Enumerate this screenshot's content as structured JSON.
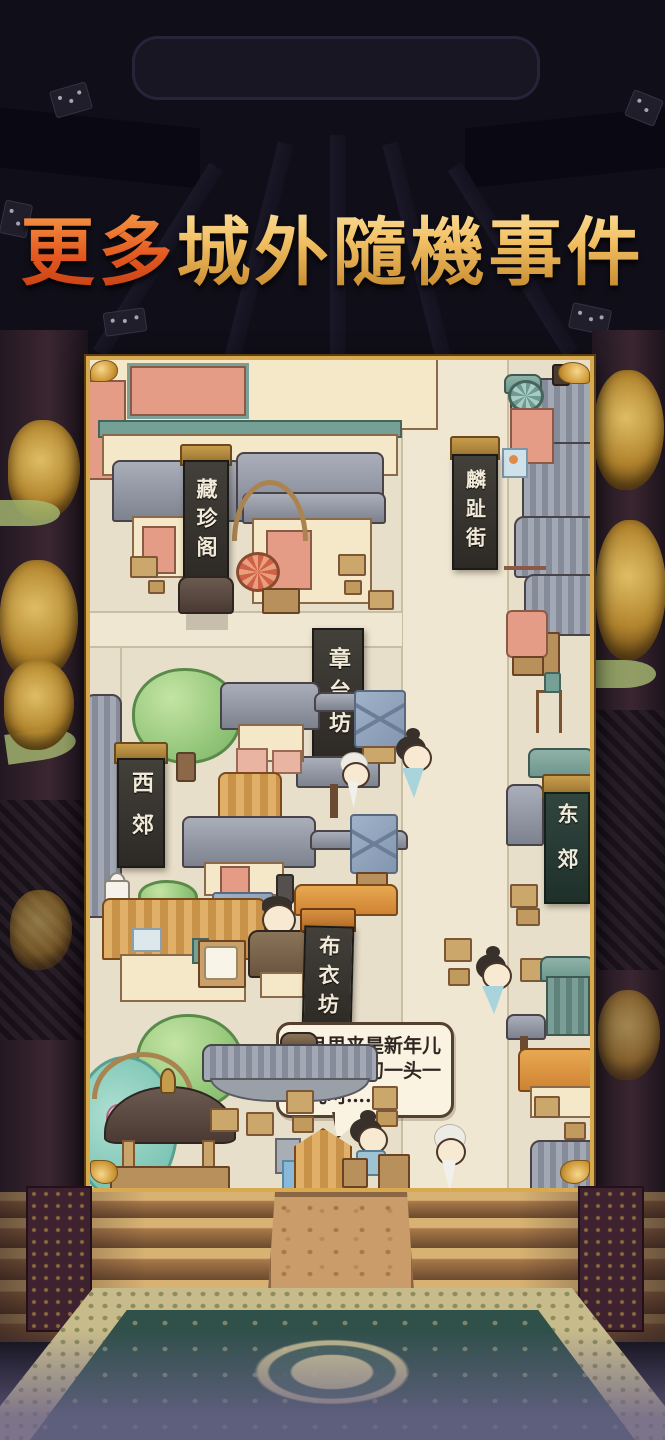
{
  "title": {
    "part1": "更多",
    "part2": "城外隨機事件",
    "full": "更多城外隨機事件"
  },
  "map": {
    "banners": [
      {
        "id": "cang-zhen-ge",
        "text": "藏珍阁"
      },
      {
        "id": "lin-zhi-jie",
        "text": "麟趾街"
      },
      {
        "id": "zhang-tai-fang",
        "text": "章台坊"
      },
      {
        "id": "xi-jiao",
        "text": "西郊"
      },
      {
        "id": "dong-jiao",
        "text": "东郊"
      },
      {
        "id": "bu-yi-fang",
        "text": "布衣坊"
      }
    ],
    "speech_bubble": {
      "text": "正月里来是新年儿呵，大年初一头一天儿呵……"
    }
  },
  "colors": {
    "frame_gold": "#d9a94f",
    "map_bg": "#e8dfca",
    "banner_dark": "#353230",
    "bubble_bg": "#fbf3e2",
    "title_orange": "#e2571f",
    "title_gold": "#f2c064",
    "carpet_teal": "#34544b",
    "stair_tan": "#c9a05a"
  }
}
